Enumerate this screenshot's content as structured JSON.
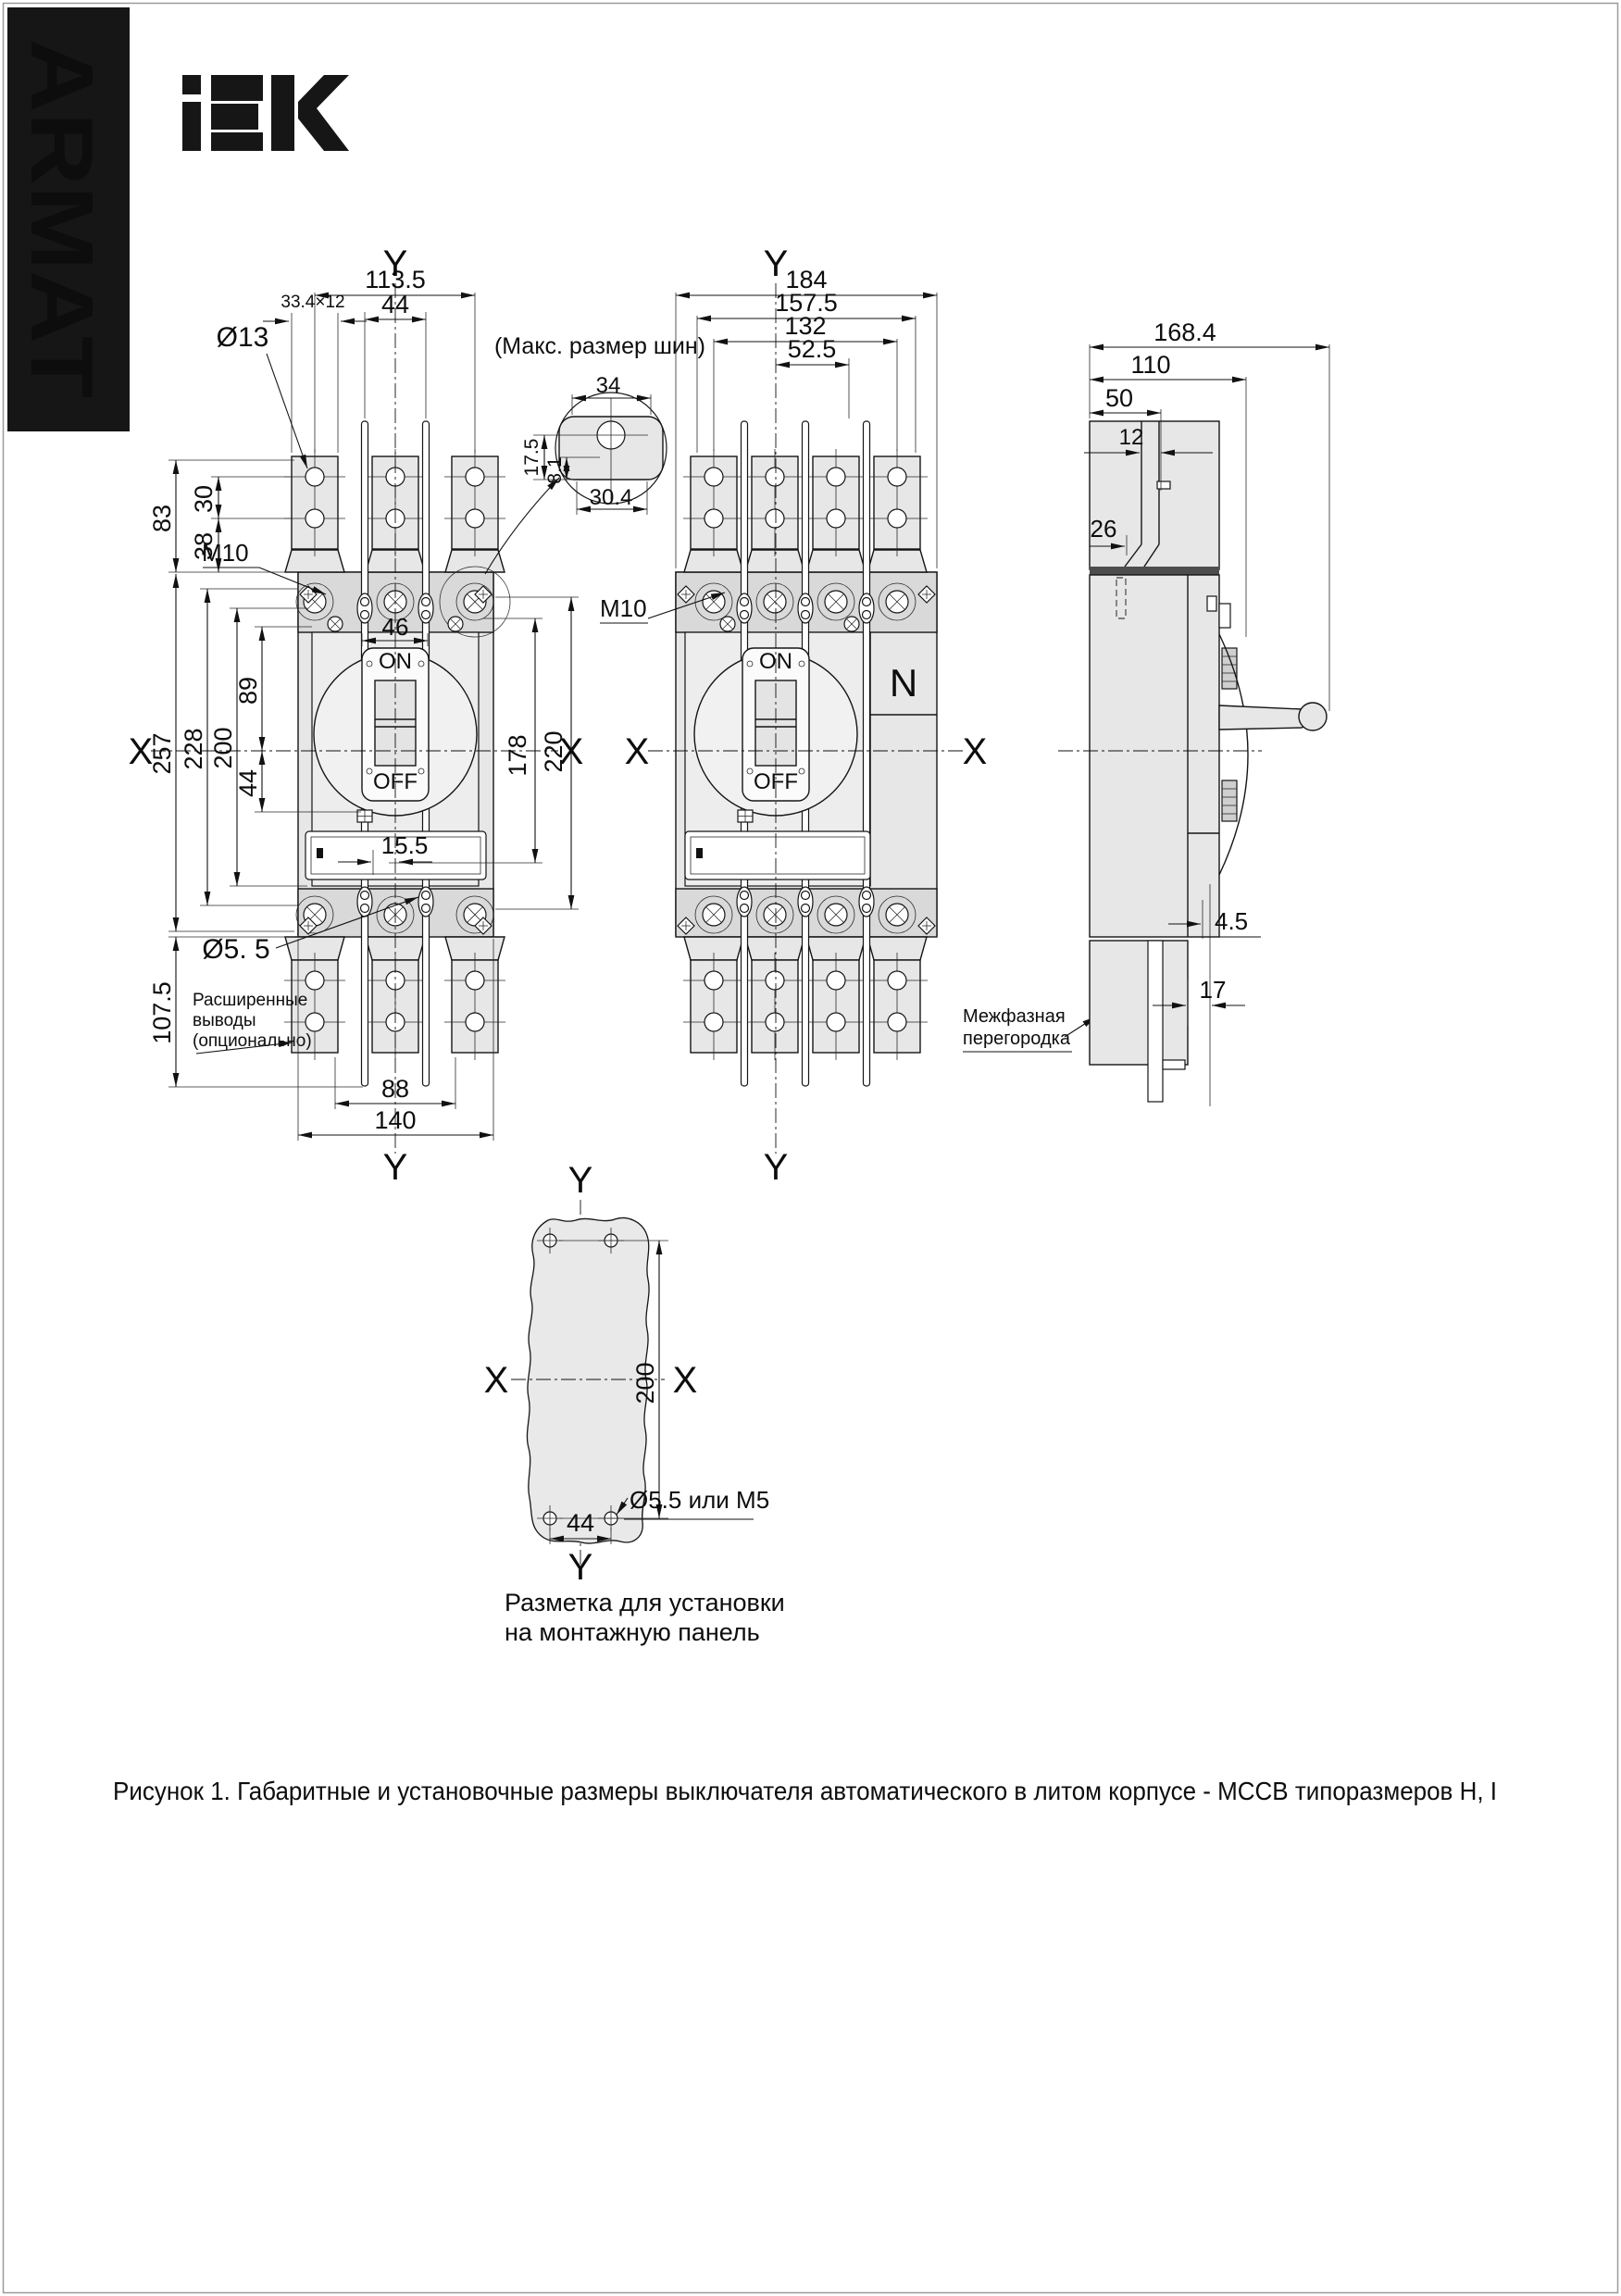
{
  "page": {
    "brand_vertical": "ARMAT",
    "figure_caption": "Рисунок 1. Габаритные и установочные размеры выключателя автоматического в литом корпусе - МССВ типоразмеров  Н, I"
  },
  "front_view_3p": {
    "axis": {
      "top": "Y",
      "bottom": "Y",
      "left": "X",
      "right": "X"
    },
    "dims": {
      "overall_width": "113.5",
      "rod_pitch": "44",
      "slot": "33.4×12",
      "lug_hole": "Ø13",
      "h83": "83",
      "h30": "30",
      "h38": "38",
      "thread": "M10",
      "h257": "257",
      "h228": "228",
      "h200": "200",
      "h89": "89",
      "h44": "44",
      "handle_width": "46",
      "h178": "178",
      "h220": "220",
      "plate_offset": "15.5",
      "base_hole": "Ø5. 5",
      "h107": "107.5",
      "w88": "88",
      "w140": "140"
    },
    "labels": {
      "on": "ON",
      "off": "OFF",
      "note1": "Расширенные",
      "note2": "выводы",
      "note3": "(опционально)"
    }
  },
  "busbar_detail": {
    "title": "(Макс. размер шин)",
    "dims": {
      "w34": "34",
      "h175": "17.5",
      "h81": "8.1",
      "w304": "30.4"
    }
  },
  "front_view_4p": {
    "axis": {
      "top": "Y",
      "bottom": "Y",
      "left": "X",
      "right": "X"
    },
    "dims": {
      "w184": "184",
      "w157": "157.5",
      "w132": "132",
      "w52": "52.5",
      "thread": "M10"
    },
    "labels": {
      "on": "ON",
      "off": "OFF",
      "neutral": "N",
      "note1": "Межфазная",
      "note2": "перегородка"
    }
  },
  "side_view": {
    "dims": {
      "w168": "168.4",
      "w110": "110",
      "w50": "50",
      "w12": "12",
      "w26": "26",
      "gap45": "4.5",
      "off17": "17"
    }
  },
  "mounting_template": {
    "axis": {
      "top": "Y",
      "bottom": "Y",
      "left": "X",
      "right": "X"
    },
    "dims": {
      "h200": "200",
      "w44": "44",
      "hole": "Ø5.5 или М5"
    },
    "caption1": "Разметка для установки",
    "caption2": "на монтажную панель"
  }
}
